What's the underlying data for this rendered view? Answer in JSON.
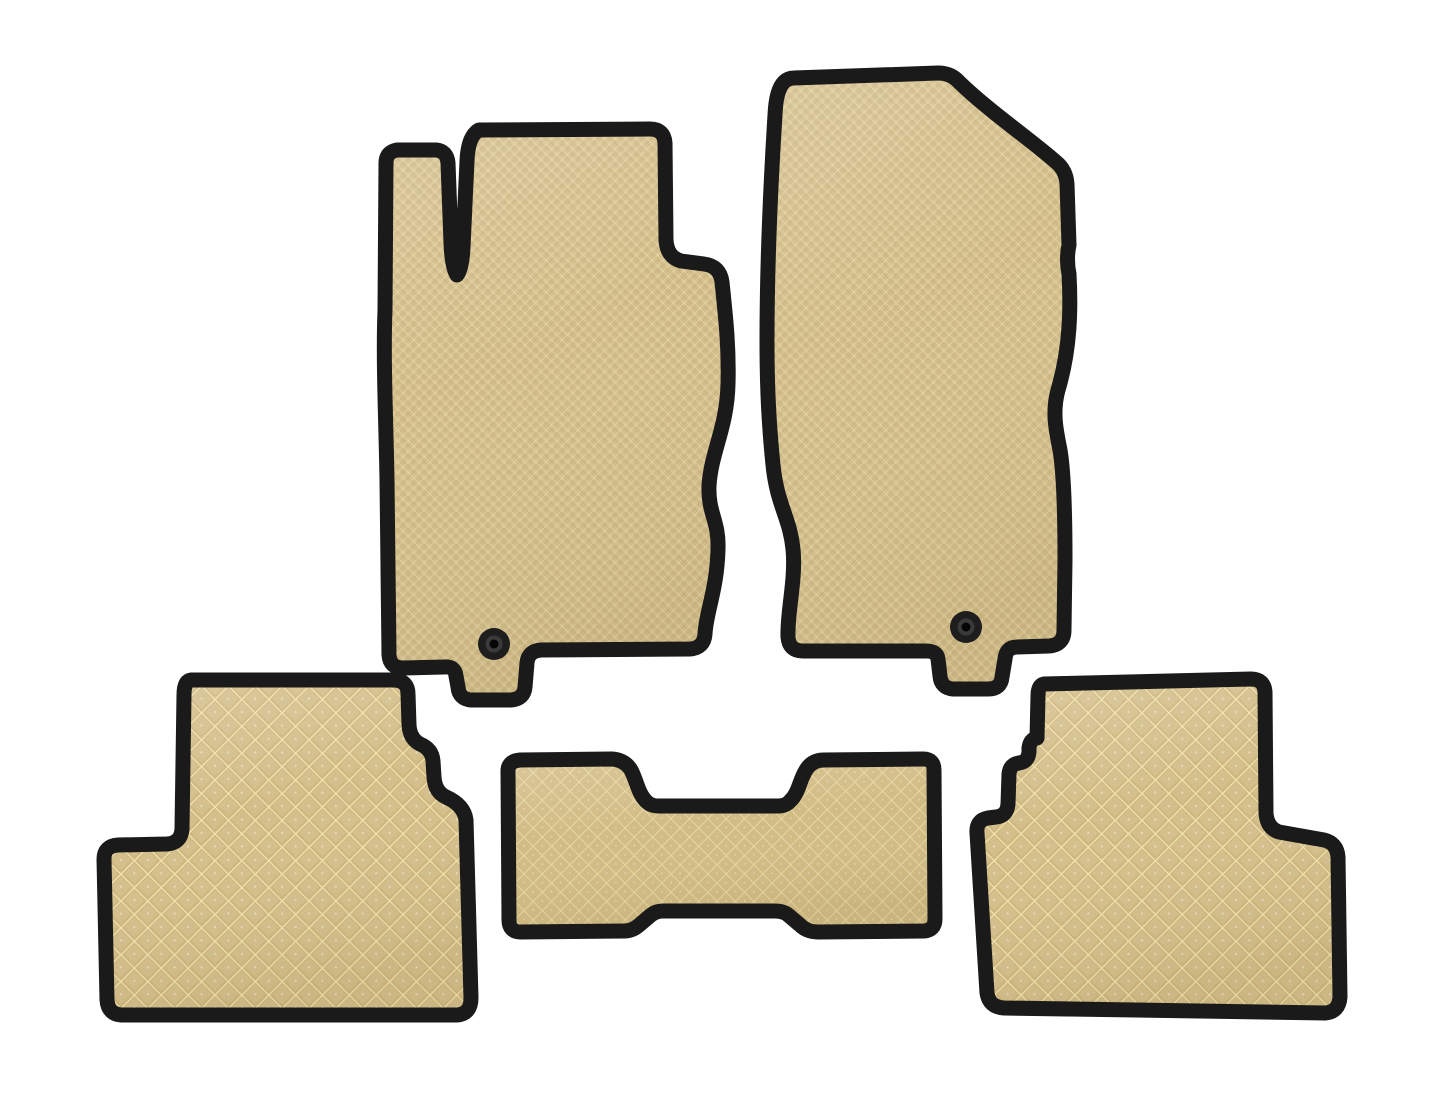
{
  "image": {
    "title": "Set of five beige EVA car floor mats with black trim",
    "background_color": "#ffffff",
    "pieces_count": 5
  },
  "colors": {
    "background": "#ffffff",
    "border": "#1a1a1a",
    "front_base": "#d3be8c",
    "front_line": "#e7d7a6",
    "front_line_soft": "#bca468",
    "rear_base": "#cfb87f",
    "rear_line": "#f0e2b2",
    "center_base": "#d2bc85",
    "center_line": "#e9daa9",
    "fastener_outer": "#1e1e1e",
    "fastener_ring": "#3a3a3a",
    "fastener_hole": "#050505"
  },
  "mats": [
    {
      "id": "driver",
      "label": "Driver-side front mat",
      "position": "top-left",
      "texture": "fine diamond weave",
      "fasteners": 1
    },
    {
      "id": "passenger",
      "label": "Passenger-side front mat",
      "position": "top-right",
      "texture": "fine diamond weave",
      "fasteners": 1
    },
    {
      "id": "rear-left",
      "label": "Rear left mat",
      "position": "bottom-left",
      "texture": "large diamond grid",
      "fasteners": 0
    },
    {
      "id": "center-tunnel",
      "label": "Center tunnel mat",
      "position": "bottom-center",
      "texture": "medium diamond grid",
      "fasteners": 0
    },
    {
      "id": "rear-right",
      "label": "Rear right mat",
      "position": "bottom-right",
      "texture": "large diamond grid",
      "fasteners": 0
    }
  ]
}
